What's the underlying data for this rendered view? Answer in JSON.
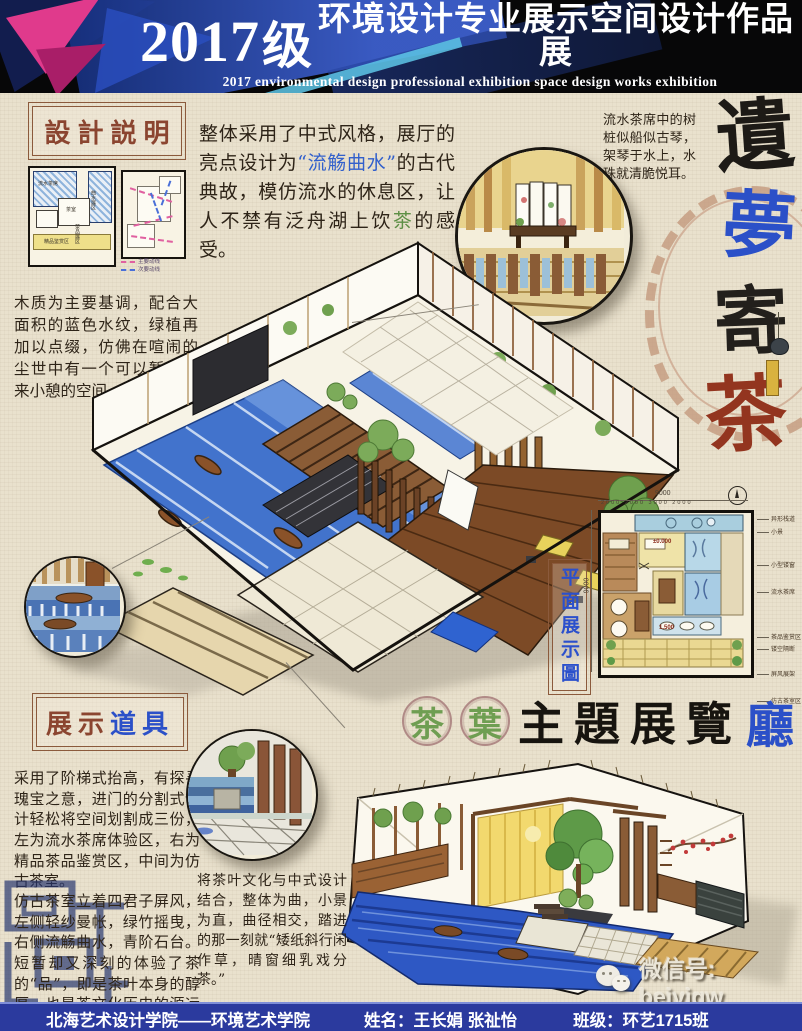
{
  "header": {
    "year": "2017",
    "grade": "级",
    "title_cn": "环境设计专业展示空间设计作品展",
    "title_en": "2017 environmental design professional exhibition space design works exhibition"
  },
  "design_note": {
    "heading": "設計説明",
    "body": "木质为主要基调，配合大面积的蓝色水纹，绿植再加以点缀，仿佛在喧闹的尘世中有一个可以暂停下来小憩的空间。",
    "plan_labels": [
      "流水茶席",
      "曲水展区",
      "茶室",
      "茶品展区",
      "精品鉴赏区"
    ],
    "legend": [
      "主要动线",
      "次要动线"
    ]
  },
  "intro": {
    "p1": "整体采用了中式风格，展厅的亮点设计为",
    "hl_blue": "“流觞曲水”",
    "p2": "的古代典故，模仿流水的休息区，让人不禁有泛舟湖上饮",
    "hl_green": "茶",
    "p3": "的感受。"
  },
  "side_note": "流水茶席中的树桩似船似古琴，架琴于水上，水珠就清脆悦耳。",
  "calligraphy": {
    "c1": "遺",
    "c2": "夢",
    "c3": "寄",
    "c4": "茶"
  },
  "plan_section": {
    "label": "平面展示圖",
    "dim_top_total": "9000",
    "dim_top_parts": "2000  2000  3000  2000",
    "dim_left_total": "9000",
    "level_a": "±0.000",
    "level_b": "1.500",
    "annotations": [
      "异形栈道",
      "小景",
      "小型镂窗",
      "流水茶席",
      "茶品鉴赏区",
      "镂空隔断",
      "屏风展架",
      "仿古茶室区"
    ]
  },
  "props_note": {
    "heading_a": "展示",
    "heading_b": "道具",
    "para1": "采用了阶梯式抬高，有探寻瑰宝之意，进门的分割式设计轻松将空间划割成三份，左为流水茶席体验区，右为精品茶品鉴赏区，中间为仿古茶室。",
    "para2": "仿古茶室立着四君子屏风，左侧轻纱曼帐，绿竹摇曳，右侧流觞曲水，青阶石台。短暂却又深刻的体验了茶的“品”，即是茶叶本身的醇厚，也是茶文化历史的源远流长。"
  },
  "hall_title": {
    "badge1": "茶",
    "badge2": "葉",
    "main": "主題展覽",
    "accent": "廳"
  },
  "closing_note": "将茶叶文化与中式设计结合，整体为曲，小景为直，曲径相交，踏进的那一刻就“矮纸斜行闲作草，晴窗细乳戏分茶。”",
  "wechat": {
    "label": "微信号: beiyigw"
  },
  "footer": {
    "school": "北海艺术设计学院——环境艺术学院",
    "name": "姓名：王长娟 张祉怡",
    "class": "班级：环艺1715班"
  },
  "colors": {
    "accent_blue": "#2b50c8",
    "accent_green": "#5d8f45",
    "accent_red": "#93351f",
    "water_blue": "#4273cc",
    "footer_blue": "#2b3a9e"
  }
}
